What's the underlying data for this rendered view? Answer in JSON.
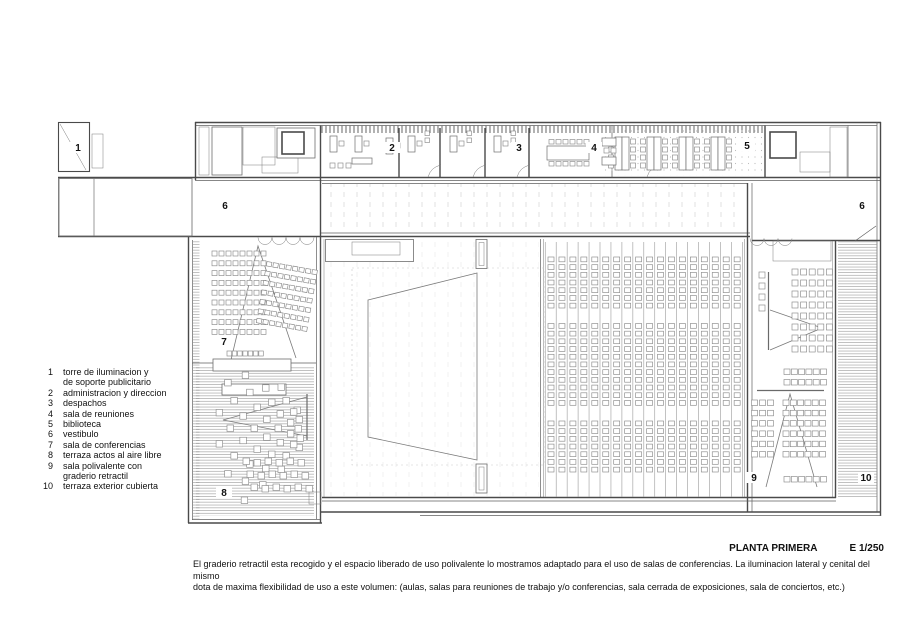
{
  "title": {
    "name": "PLANTA PRIMERA",
    "scale": "E 1/250"
  },
  "caption": {
    "line1": "El graderio retractil esta recogido y el espacio liberado de uso polivalente lo mostramos adaptado para el uso de salas de conferencias. La iluminacion lateral y cenital  del mismo",
    "line2": "dota de maxima flexibilidad de uso a este volumen: (aulas, salas para reuniones de trabajo y/o conferencias, sala cerrada de exposiciones, sala de conciertos, etc.)"
  },
  "legend": {
    "items": [
      {
        "num": "1",
        "label": "torre de iluminacion y\nde soporte publicitario"
      },
      {
        "num": "2",
        "label": "administracion y direccion"
      },
      {
        "num": "3",
        "label": "despachos"
      },
      {
        "num": "4",
        "label": "sala de reuniones"
      },
      {
        "num": "5",
        "label": "biblioteca"
      },
      {
        "num": "6",
        "label": "vestibulo"
      },
      {
        "num": "7",
        "label": "sala de conferencias"
      },
      {
        "num": "8",
        "label": "terraza actos al aire libre"
      },
      {
        "num": "9",
        "label": "sala polivalente con\ngraderio retractil"
      },
      {
        "num": "10",
        "label": "terraza exterior cubierta"
      }
    ]
  },
  "plan": {
    "room_labels": [
      {
        "n": "1",
        "x": 78,
        "y": 151
      },
      {
        "n": "2",
        "x": 392,
        "y": 151
      },
      {
        "n": "3",
        "x": 519,
        "y": 151
      },
      {
        "n": "4",
        "x": 594,
        "y": 151
      },
      {
        "n": "5",
        "x": 747,
        "y": 149
      },
      {
        "n": "6",
        "x": 225,
        "y": 209
      },
      {
        "n": "6",
        "x": 862,
        "y": 209
      },
      {
        "n": "7",
        "x": 224,
        "y": 345
      },
      {
        "n": "8",
        "x": 224,
        "y": 496
      },
      {
        "n": "9",
        "x": 754,
        "y": 481
      },
      {
        "n": "10",
        "x": 866,
        "y": 481
      }
    ],
    "colors": {
      "wall": "#4a4a4a",
      "thin_line": "#5f5f5f",
      "hatch": "#999999",
      "paper": "#ffffff"
    }
  }
}
